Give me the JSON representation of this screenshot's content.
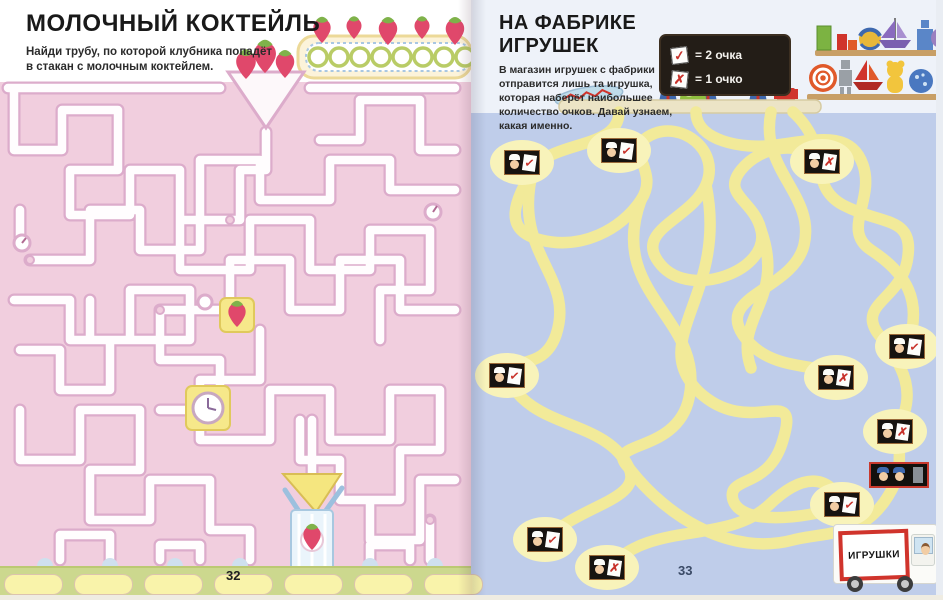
{
  "left_page": {
    "title": "МОЛОЧНЫЙ КОКТЕЙЛЬ",
    "instructions": "Найди трубу, по которой клубника попадёт в стакан с молочным коктейлем.",
    "page_number": "32"
  },
  "right_page": {
    "title": "НА ФАБРИКЕ ИГРУШЕК",
    "instructions": "В магазин игрушек с фабрики отправится лишь та игрушка, которая наберёт наибольшее количество очков. Давай узнаем, какая именно.",
    "legend": {
      "rows": [
        {
          "symbol": "✓",
          "label": "= 2 очка"
        },
        {
          "symbol": "✗",
          "label": "= 1 очко"
        }
      ]
    },
    "truck_sign": "ИГРУШКИ",
    "page_number": "33",
    "tags": [
      {
        "x": 33,
        "y": 150,
        "mark": "✓"
      },
      {
        "x": 130,
        "y": 138,
        "mark": "✓"
      },
      {
        "x": 333,
        "y": 149,
        "mark": "✗"
      },
      {
        "x": 18,
        "y": 363,
        "mark": "✓"
      },
      {
        "x": 418,
        "y": 334,
        "mark": "✓"
      },
      {
        "x": 347,
        "y": 365,
        "mark": "✗"
      },
      {
        "x": 406,
        "y": 419,
        "mark": "✗"
      },
      {
        "x": 353,
        "y": 492,
        "mark": "✓"
      },
      {
        "x": 56,
        "y": 527,
        "mark": "✓"
      },
      {
        "x": 118,
        "y": 555,
        "mark": "✗"
      }
    ]
  },
  "colors": {
    "left_background": "#f1cede",
    "right_background": "#bfcdea",
    "pipe_outline": "#dcaccb",
    "rope_yellow": "#f2ea99",
    "accent_red": "#c8322b",
    "belt_green": "#ccd88e"
  }
}
